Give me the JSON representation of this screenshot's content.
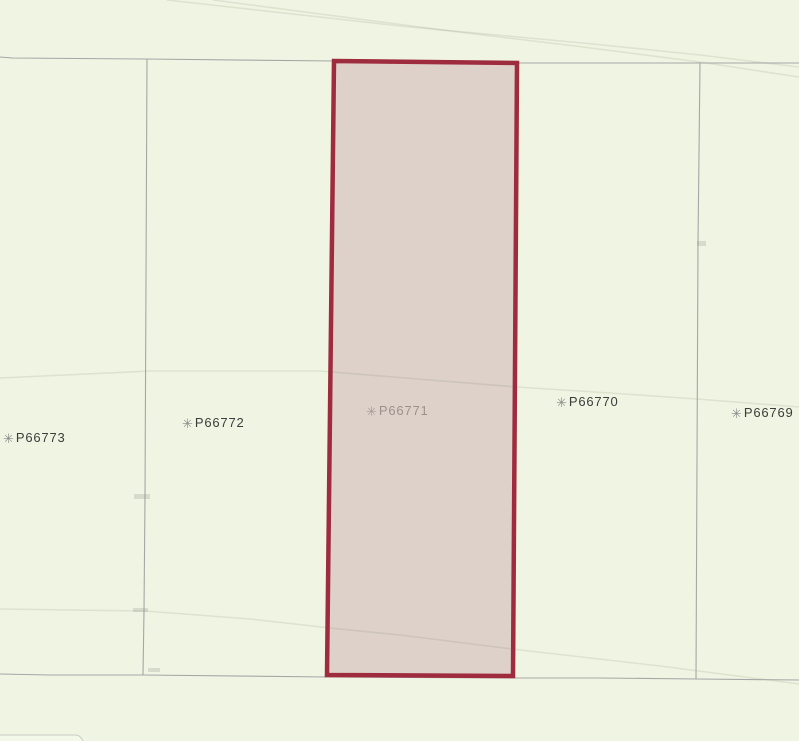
{
  "map": {
    "width": 799,
    "height": 741,
    "background_color": "#eff5e2",
    "boundary_color": "#a6a6a6",
    "road_color": "rgba(100,105,85,0.13)",
    "artifact_color": "rgba(150,150,143,0.28)",
    "selected_parcel": {
      "label": "P66771",
      "fill": "#ddd1c9",
      "border_color": "#9e2b3e",
      "border_width": 4.5,
      "points": "334,61 517,63 513,676 327,675"
    },
    "boundaries": [
      {
        "name": "north-boundary",
        "points": "0,57 12,58 145,59 334,61 517,63 570,63 799,63"
      },
      {
        "name": "south-boundary",
        "points": "0,674 50,675 143,675 327,677 513,678 600,678 697,679 799,680"
      },
      {
        "name": "west-boundary",
        "points": "147,59 145,497 144,611 143,675"
      },
      {
        "name": "east-boundary",
        "points": "700,63 698,243 696,679"
      }
    ],
    "roads": [
      {
        "name": "road-upper-a",
        "points": "167,0 400,26 583,43 700,55 799,67"
      },
      {
        "name": "road-upper-b",
        "points": "213,0 450,31 583,47 700,62 799,77"
      },
      {
        "name": "road-middle",
        "points": "0,378 150,371 320,371 430,380 517,387 625,394 697,399 799,407"
      },
      {
        "name": "road-lower",
        "points": "0,609 145,611 250,619 330,628 400,635 512,649 660,666 745,677 799,684"
      }
    ],
    "bottom_left_shape": {
      "x": -30,
      "y": 735,
      "width": 113,
      "height": 30,
      "rx": 8,
      "fill": "#f3f8e9",
      "stroke": "#c9cdc0"
    },
    "artifacts": [
      {
        "x": 134,
        "y": 494,
        "width": 16,
        "height": 5
      },
      {
        "x": 133,
        "y": 608,
        "width": 15,
        "height": 4
      },
      {
        "x": 697,
        "y": 241,
        "width": 9,
        "height": 5
      },
      {
        "x": 148,
        "y": 668,
        "width": 12,
        "height": 4
      },
      {
        "x": 418,
        "y": 668,
        "width": 22,
        "height": 4
      }
    ],
    "label_icon_glyph": "✳",
    "labels": [
      {
        "id": "P66773",
        "left": 3,
        "top": 430,
        "text_color": "#3c3c3c",
        "icon_color": "#8a8a8a"
      },
      {
        "id": "P66772",
        "left": 182,
        "top": 415,
        "text_color": "#3c3c3c",
        "icon_color": "#8a8a8a"
      },
      {
        "id": "P66771",
        "left": 366,
        "top": 403,
        "text_color": "#9b928d",
        "icon_color": "#a59c97"
      },
      {
        "id": "P66770",
        "left": 556,
        "top": 394,
        "text_color": "#3c3c3c",
        "icon_color": "#8a8a8a"
      },
      {
        "id": "P66769",
        "left": 731,
        "top": 405,
        "text_color": "#3c3c3c",
        "icon_color": "#8a8a8a"
      }
    ]
  }
}
